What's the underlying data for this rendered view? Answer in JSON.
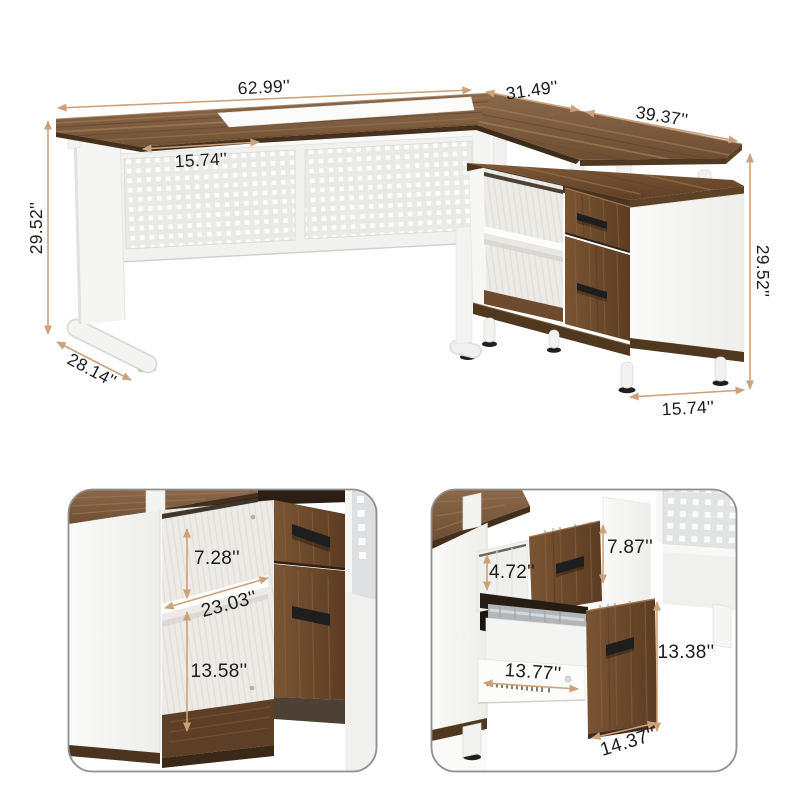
{
  "colors": {
    "accent_arrow": "#CDA17A",
    "label_text": "#1C1C1C",
    "wood_light": "#8B674A",
    "wood_dark": "#5C3C22",
    "wood_edge": "#46311E",
    "panel_white": "#F6F6F5",
    "mesh_gray": "#E8E8E8",
    "handle_black": "#1E1E1E",
    "card_border": "#8F8F8F"
  },
  "main_view": {
    "dims": {
      "desk_width": "62.99''",
      "top_inset_width": "15.74''",
      "back_edge_left": "31.49''",
      "back_edge_right": "39.37''",
      "height_left": "29.52''",
      "desk_depth": "28.14''",
      "height_right": "29.52''",
      "cabinet_depth": "15.74''"
    }
  },
  "shelf_detail": {
    "dims": {
      "upper_shelf_height": "7.28''",
      "shelf_depth": "23.03''",
      "lower_shelf_height": "13.58''"
    }
  },
  "drawer_detail": {
    "dims": {
      "inner_height": "4.72''",
      "top_drawer_front": "7.87''",
      "bottom_drawer_front": "13.38''",
      "slide_length": "13.77''",
      "drawer_width": "14.37''"
    }
  }
}
